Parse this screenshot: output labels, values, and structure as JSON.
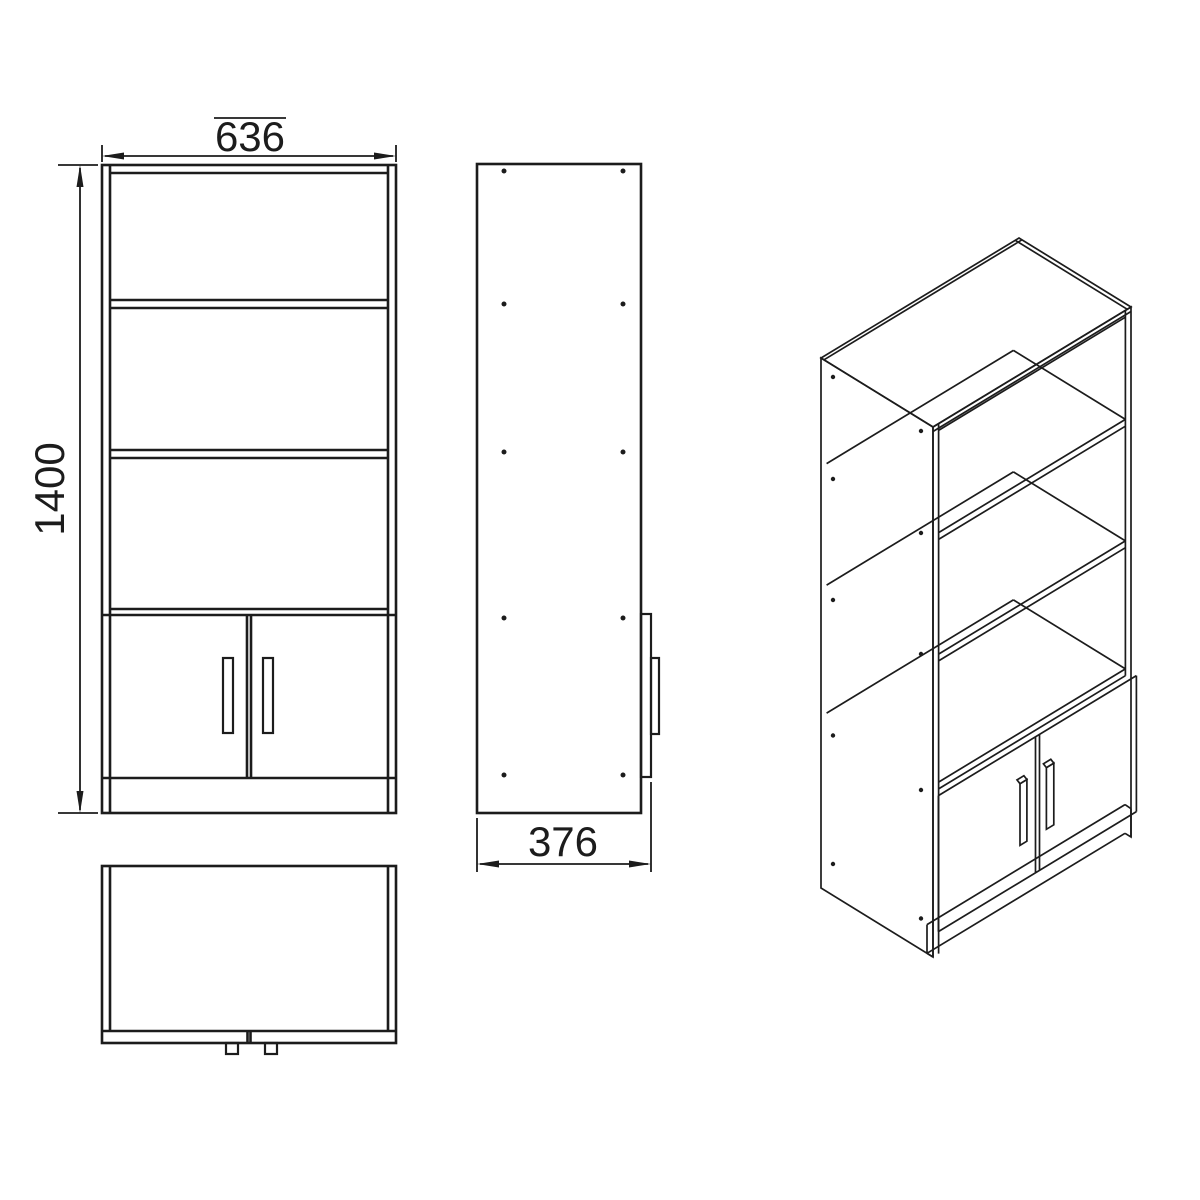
{
  "document": {
    "type": "furniture-assembly-technical-drawing",
    "product": "two-door bookcase cabinet"
  },
  "dimensions": {
    "width": {
      "value": "636"
    },
    "height": {
      "value": "1400"
    },
    "depth": {
      "value": "376"
    }
  },
  "views": {
    "front": {
      "name": "front-view"
    },
    "side": {
      "name": "side-view"
    },
    "top": {
      "name": "top-view"
    },
    "isometric": {
      "name": "isometric-view"
    }
  },
  "colors": {
    "line": "#1c1c1c",
    "background": "#ffffff"
  }
}
